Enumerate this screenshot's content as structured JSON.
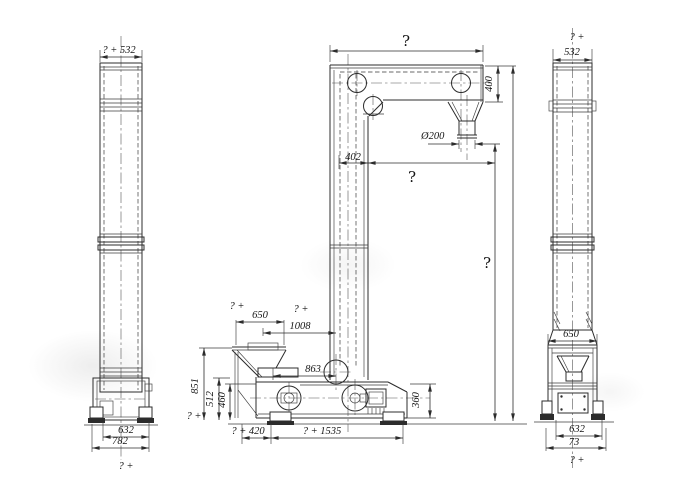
{
  "drawing": {
    "background": "#ffffff",
    "line_color": "#2c2c2c"
  },
  "labels": {
    "left_view": {
      "top_width": "? + 532",
      "base_inner_width": "632",
      "base_outer_width": "782",
      "bottom_note": "? +"
    },
    "center_view": {
      "head_width": "?",
      "head_height": "400",
      "spout_diameter": "Ø200",
      "casing_width": "402",
      "discharge_offset": "?",
      "discharge_height": "?",
      "hopper_note": "? +",
      "hopper_width": "650",
      "inlet_note": "? +",
      "inlet_offset": "1008",
      "boot_offset": "863",
      "hopper_height": "851",
      "support_height": "512",
      "leg_height": "460",
      "ground_note": "? +",
      "foot_offset": "? + 420",
      "base_length": "? + 1535",
      "boot_height": "360"
    },
    "right_view": {
      "top_note": "? +",
      "top_width": "532",
      "boot_width": "650",
      "base_inner_width": "632",
      "base_outer_width": "73",
      "bottom_note": "? +"
    }
  }
}
